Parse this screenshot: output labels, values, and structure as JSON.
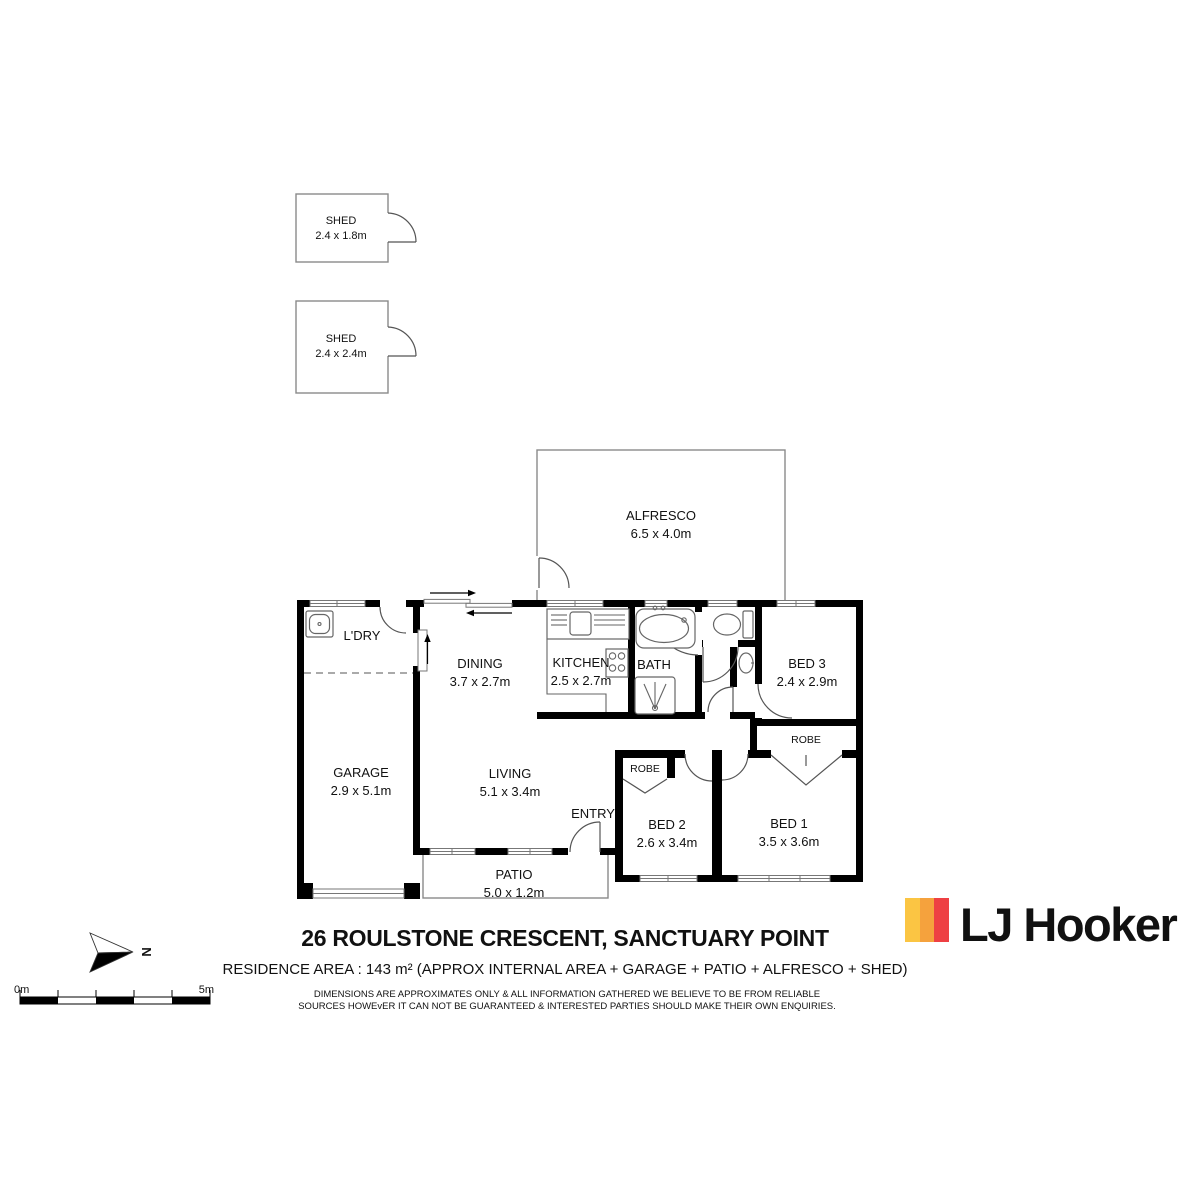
{
  "title_block": {
    "address": "26 ROULSTONE CRESCENT, SANCTUARY POINT",
    "area_line": "RESIDENCE AREA : 143 m²  (APPROX INTERNAL AREA + GARAGE + PATIO + ALFRESCO + SHED)",
    "disclaimer_line1": "DIMENSIONS ARE APPROXIMATES ONLY & ALL INFORMATION GATHERED WE BELIEVE TO BE FROM RELIABLE",
    "disclaimer_line2": "SOURCES HOWEvER IT CAN NOT BE GUARANTEED & INTERESTED PARTIES SHOULD MAKE THEIR OWN ENQUIRIES."
  },
  "brand": {
    "logo_text": "LJ Hooker",
    "stripe_yellow": "#FBC543",
    "stripe_orange": "#F5A23D",
    "stripe_red": "#EE4043"
  },
  "compass": {
    "north_label": "N"
  },
  "scale_bar": {
    "start_label": "0m",
    "end_label": "5m"
  },
  "rooms": {
    "shed_small": {
      "name": "SHED",
      "dims": "2.4 x 1.8m"
    },
    "shed_large": {
      "name": "SHED",
      "dims": "2.4 x 2.4m"
    },
    "alfresco": {
      "name": "ALFRESCO",
      "dims": "6.5 x 4.0m"
    },
    "laundry": {
      "name": "L'DRY"
    },
    "dining": {
      "name": "DINING",
      "dims": "3.7 x 2.7m"
    },
    "kitchen": {
      "name": "KITCHEN",
      "dims": "2.5 x 2.7m"
    },
    "bath": {
      "name": "BATH"
    },
    "bed3": {
      "name": "BED 3",
      "dims": "2.4 x 2.9m"
    },
    "robe_bed1": {
      "name": "ROBE"
    },
    "robe_bed2": {
      "name": "ROBE"
    },
    "garage": {
      "name": "GARAGE",
      "dims": "2.9 x 5.1m"
    },
    "living": {
      "name": "LIVING",
      "dims": "5.1 x 3.4m"
    },
    "entry": {
      "name": "ENTRY"
    },
    "bed2": {
      "name": "BED 2",
      "dims": "2.6 x 3.4m"
    },
    "bed1": {
      "name": "BED 1",
      "dims": "3.5 x 3.6m"
    },
    "patio": {
      "name": "PATIO",
      "dims": "5.0 x 1.2m"
    }
  }
}
